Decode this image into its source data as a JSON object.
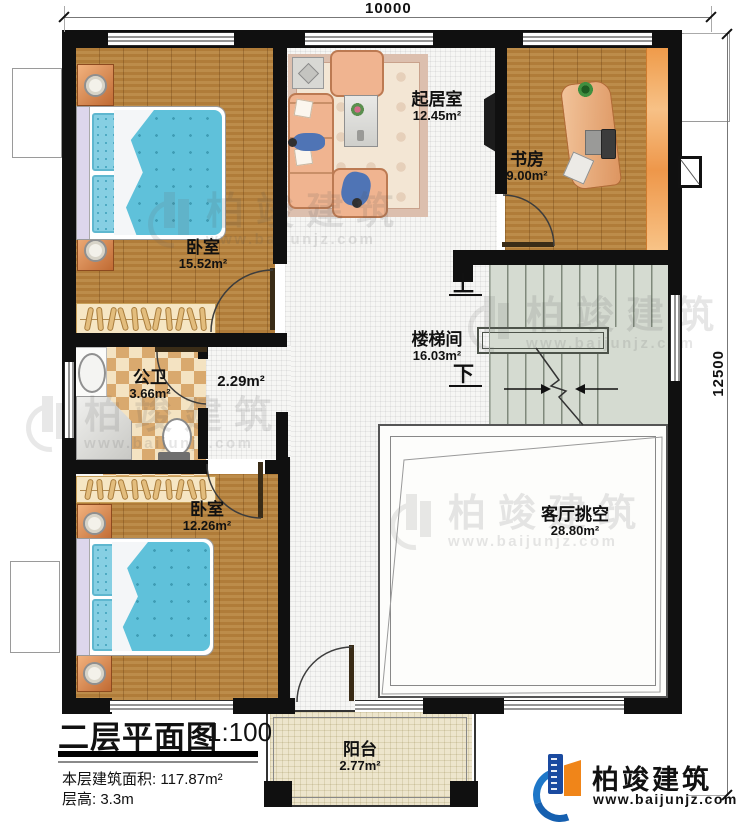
{
  "dimensions": {
    "top": "10000",
    "right": "12500"
  },
  "rooms": {
    "bedroom1": {
      "name": "卧室",
      "area": "15.52m²"
    },
    "living": {
      "name": "起居室",
      "area": "12.45m²"
    },
    "study": {
      "name": "书房",
      "area": "9.00m²"
    },
    "bathroom": {
      "name": "公卫",
      "area": "3.66m²"
    },
    "corridor": {
      "area": "2.29m²"
    },
    "stairwell": {
      "name": "楼梯间",
      "area": "16.03m²"
    },
    "bedroom2": {
      "name": "卧室",
      "area": "12.26m²"
    },
    "void": {
      "name": "客厅挑空",
      "area": "28.80m²"
    },
    "balcony": {
      "name": "阳台",
      "area": "2.77m²"
    }
  },
  "stairs": {
    "up": "上",
    "down": "下"
  },
  "title_block": {
    "title": "二层平面图",
    "scale": "1:100",
    "area_label": "本层建筑面积:",
    "area_value": "117.87m²",
    "height_label": "层高:",
    "height_value": "3.3m"
  },
  "brand": {
    "name": "柏竣建筑",
    "website": "www.baijunjz.com"
  },
  "watermark": {
    "name": "柏竣建筑",
    "website": "www.baijunjz.com"
  },
  "colors": {
    "wall": "#101010",
    "wood": "#b5813c",
    "brand_blue": "#1a4aa0",
    "brand_orange": "#f08519"
  }
}
